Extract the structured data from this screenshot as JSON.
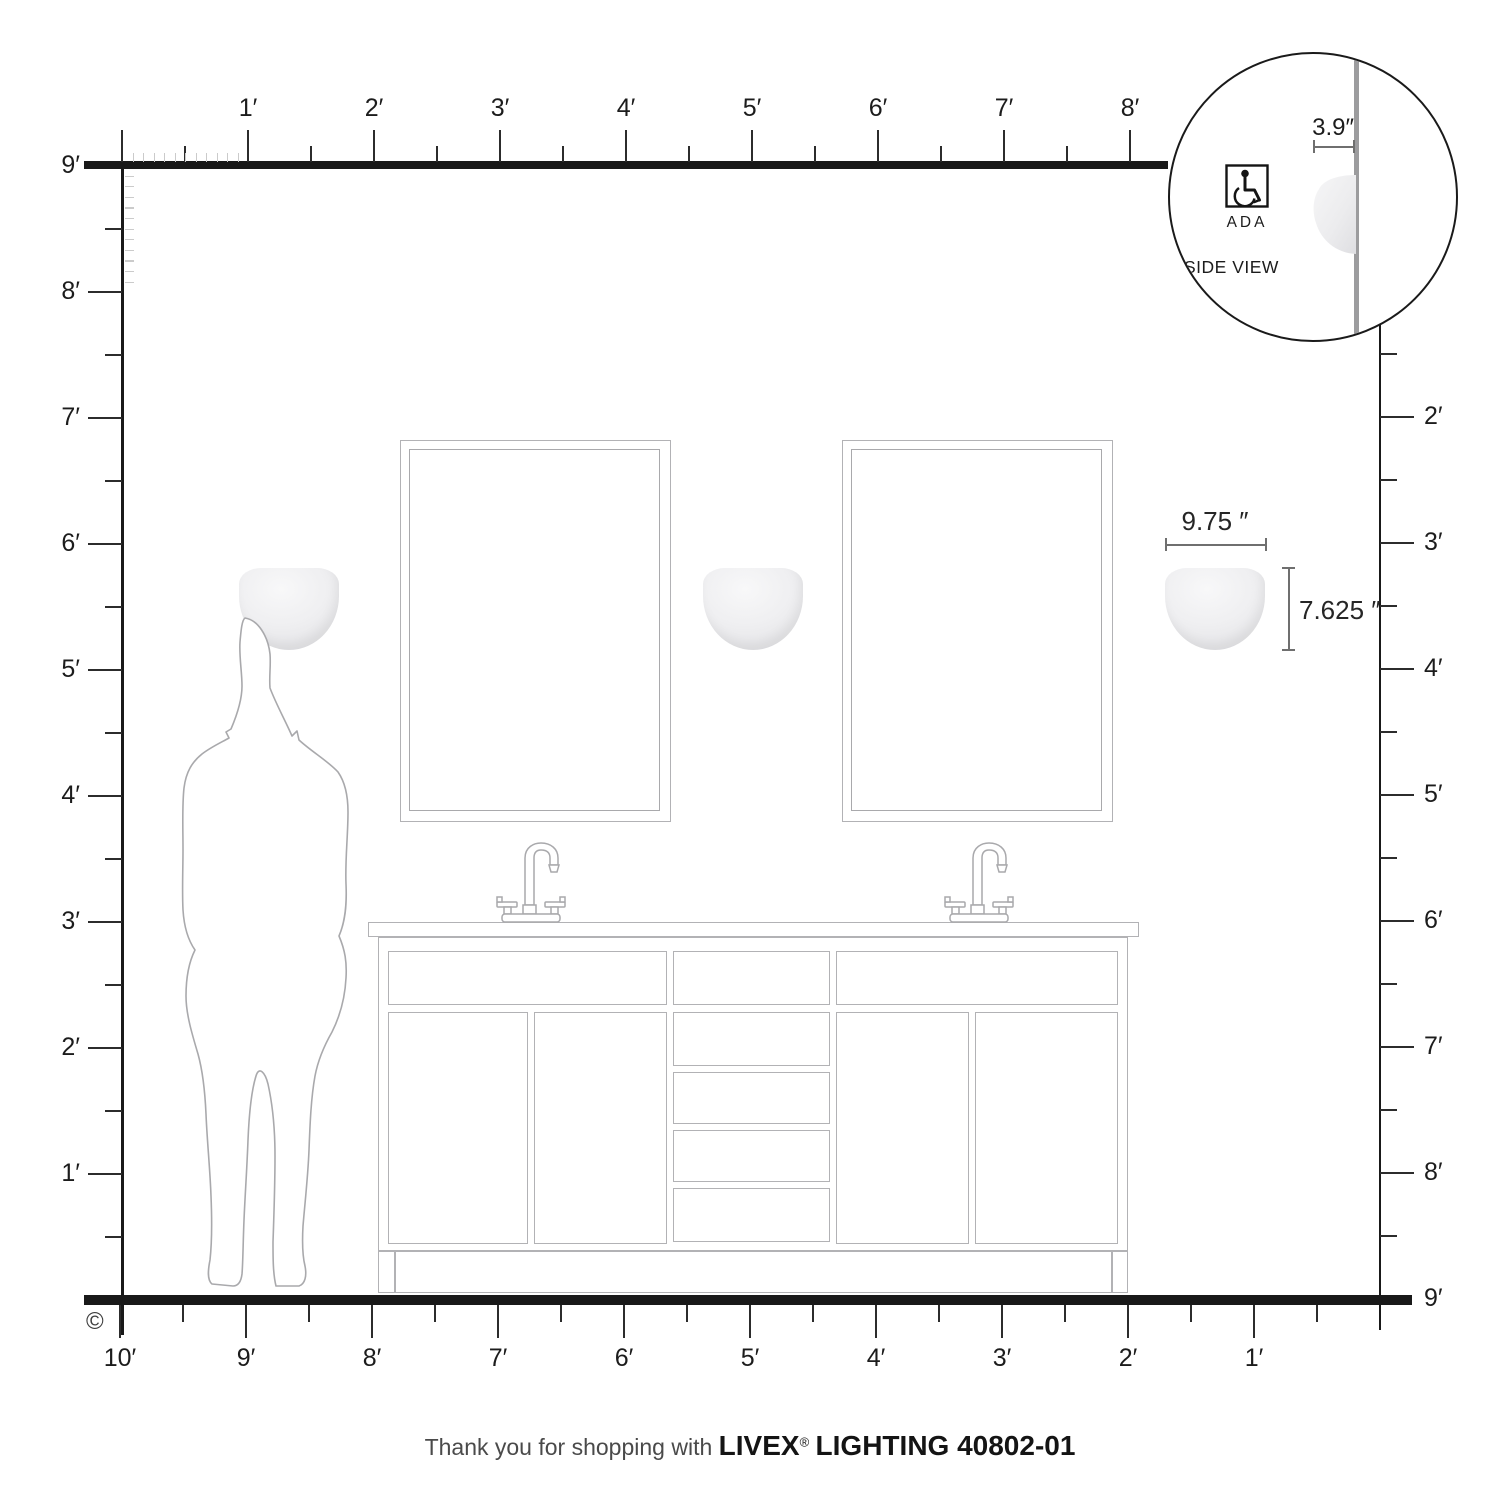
{
  "rulers": {
    "top_labels": [
      "1′",
      "2′",
      "3′",
      "4′",
      "5′",
      "6′",
      "7′",
      "8′"
    ],
    "left_labels": [
      "9′",
      "8′",
      "7′",
      "6′",
      "5′",
      "4′",
      "3′",
      "2′",
      "1′"
    ],
    "right_labels": [
      "2′",
      "3′",
      "4′",
      "5′",
      "6′",
      "7′",
      "8′",
      "9′"
    ],
    "bottom_labels": [
      "10′",
      "9′",
      "8′",
      "7′",
      "6′",
      "5′",
      "4′",
      "3′",
      "2′",
      "1′"
    ],
    "copyright": "©"
  },
  "annotations": {
    "fixture_width": "9.75 ″",
    "fixture_height": "7.625 ″",
    "fixture_depth": "3.9″"
  },
  "inset": {
    "ada_label": "ADA",
    "side_view_label": "SIDE VIEW"
  },
  "footer": {
    "prefix": "Thank you for shopping with",
    "brand": "LIVEX",
    "registered": "®",
    "suffix": "LIGHTING 40802-01"
  },
  "colors": {
    "ruler_line": "#191919",
    "tick": "#2c2c2c",
    "inch_tick": "#cbcbcb",
    "furniture_line": "#b2b2b5",
    "wall_gray": "#9c9c9e",
    "dim_line": "#6f6f6f",
    "text": "#1c1c1c"
  }
}
